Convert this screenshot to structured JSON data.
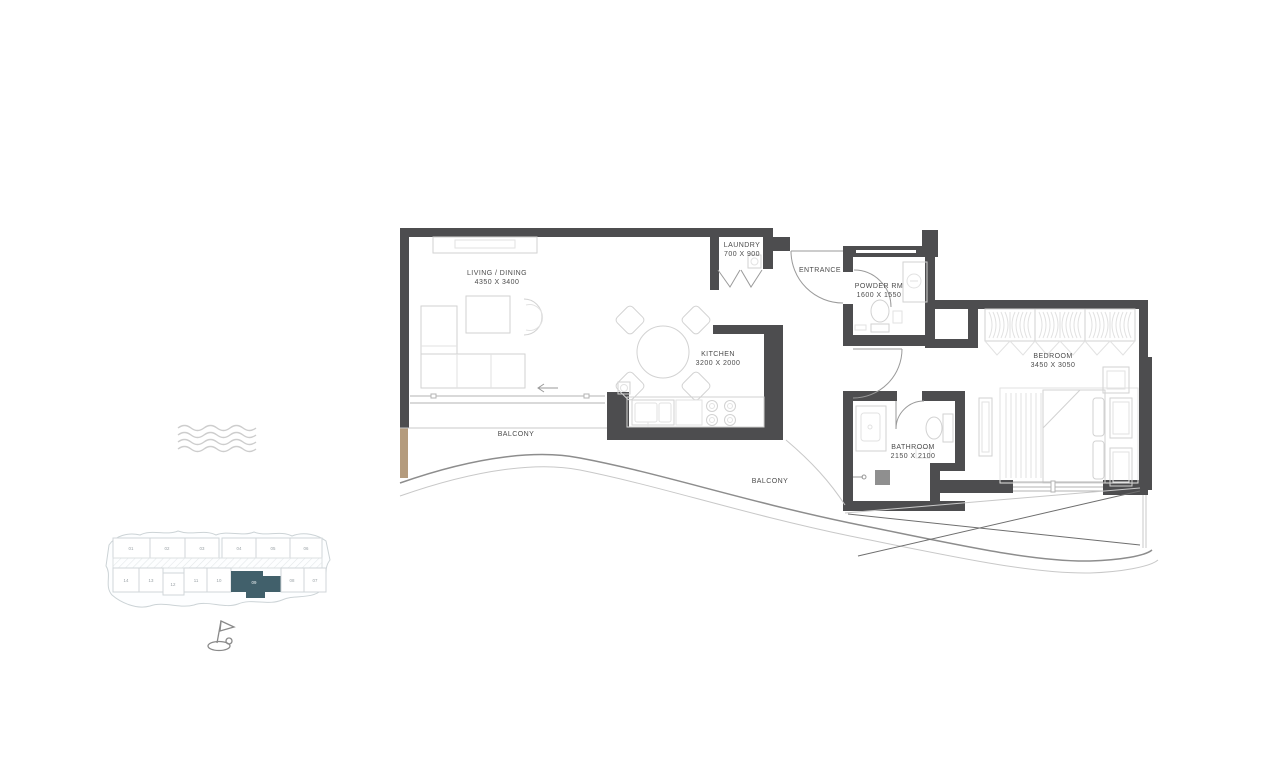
{
  "plan": {
    "rooms": {
      "living": {
        "name": "LIVING / DINING",
        "dims": "4350 X 3400"
      },
      "laundry": {
        "name": "LAUNDRY",
        "dims": "700 X 900"
      },
      "entrance": {
        "name": "ENTRANCE"
      },
      "powder": {
        "name": "POWDER RM",
        "dims": "1600 X 1550"
      },
      "kitchen": {
        "name": "KITCHEN",
        "dims": "3200 X 2000"
      },
      "bedroom": {
        "name": "BEDROOM",
        "dims": "3450 X 3050"
      },
      "bathroom": {
        "name": "BATHROOM",
        "dims": "2150 X 2100"
      },
      "balcony_left": {
        "name": "BALCONY"
      },
      "balcony_right": {
        "name": "BALCONY"
      }
    },
    "keyplan": {
      "top_row": [
        "01",
        "02",
        "03",
        "04",
        "05",
        "06"
      ],
      "bottom_row": [
        "14",
        "13",
        "12",
        "11",
        "10",
        "09",
        "08",
        "07"
      ],
      "highlighted_unit": "09"
    },
    "colors": {
      "wall": "#4d4d4f",
      "accent_tan": "#b49b7d",
      "keyplan_highlight": "#41606b",
      "label_text": "#4c4c4c"
    }
  }
}
